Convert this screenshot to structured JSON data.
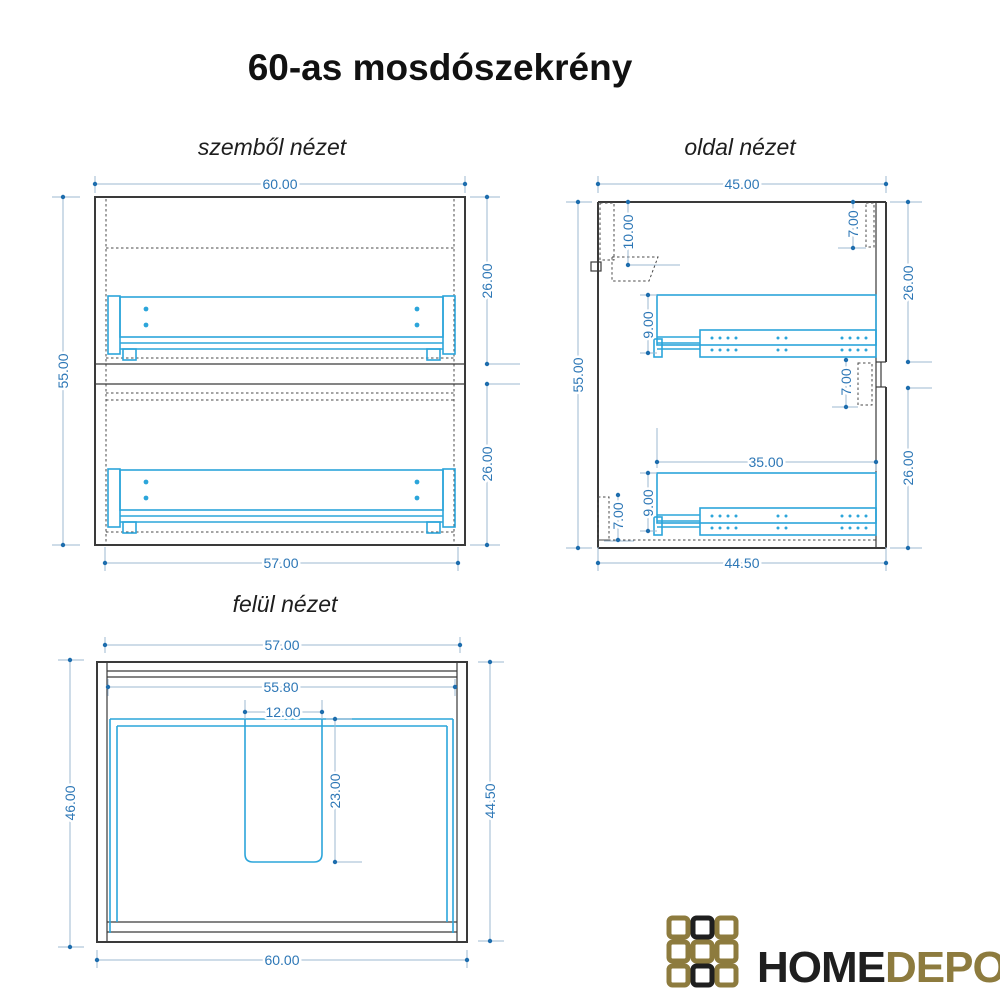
{
  "title": "60-as mosdószekrény",
  "views": {
    "front": {
      "label": "szemből nézet",
      "dims": {
        "width_top": "60.00",
        "height_left": "55.00",
        "width_bottom": "57.00",
        "drawer_upper_height": "26.00",
        "drawer_lower_height": "26.00"
      }
    },
    "side": {
      "label": "oldal nézet",
      "dims": {
        "depth_top": "45.00",
        "height_left": "55.00",
        "depth_bottom": "44.50",
        "top_rail_height": "10.00",
        "front_overlap_top": "7.00",
        "front_overlap_mid": "7.00",
        "bottom_rail_height": "7.00",
        "slide_upper_height": "9.00",
        "slide_lower_height": "9.00",
        "slide_length": "35.00",
        "front_upper_height": "26.00",
        "front_lower_height": "26.00"
      }
    },
    "top": {
      "label": "felül nézet",
      "dims": {
        "width_top": "57.00",
        "inner_width": "55.80",
        "cutout_width": "12.00",
        "cutout_depth": "23.00",
        "depth_left": "46.00",
        "depth_right": "44.50",
        "width_bottom": "60.00"
      }
    }
  },
  "logo": {
    "home": "HOME",
    "depo": "DEPO",
    "grid": [
      [
        "gold",
        "black",
        "gold"
      ],
      [
        "gold",
        "gold",
        "gold"
      ],
      [
        "gold",
        "black",
        "gold"
      ]
    ],
    "colors": {
      "gold": "#8d7b3e",
      "black": "#1f1f1f"
    }
  },
  "colors": {
    "dimension_text": "#2d77b6",
    "dimension_line": "#9db8d2",
    "dimension_dot": "#1d6dad",
    "drawing": "#3a3a3a",
    "drawer_highlight": "#2ca5da",
    "background": "#ffffff"
  }
}
